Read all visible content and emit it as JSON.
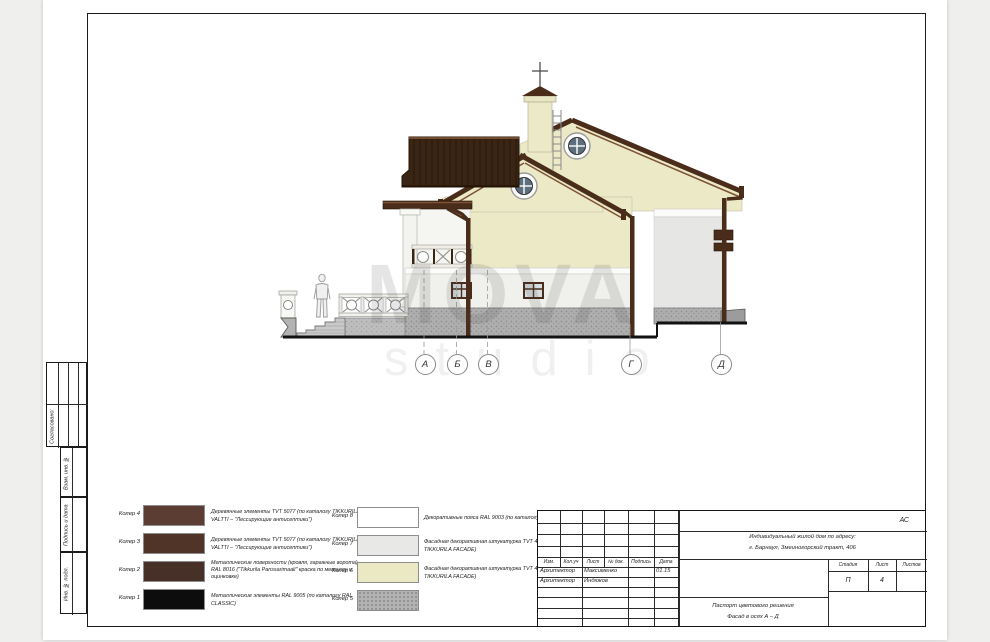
{
  "sheet": {
    "code": "АС",
    "project_line1": "Индивидуальный жилой дом по адресу:",
    "project_line2": "г. Барнаул, Змеиногорский тракт, 406",
    "doc_line1": "Паспорт цветового решения",
    "doc_line2": "Фасад в осях А – Д",
    "columns": [
      "Изм.",
      "Кол.уч",
      "Лист",
      "№ док.",
      "Подпись",
      "Дата"
    ],
    "rows": [
      {
        "role": "Архитектор",
        "surname": "Максименко",
        "signature": "",
        "date": "01.15"
      },
      {
        "role": "Архитектор",
        "surname": "Индюков",
        "signature": "",
        "date": ""
      }
    ],
    "stage_table": {
      "headers": [
        "Стадия",
        "Лист",
        "Листов"
      ],
      "stage": "П",
      "sheet_no": "4",
      "total": ""
    }
  },
  "margin": [
    "Согласовано:",
    "Взам. инв. №",
    "Подпись и дата",
    "Инв. № подл."
  ],
  "axes": {
    "labels": [
      "А",
      "Б",
      "В",
      "Г",
      "Д"
    ]
  },
  "watermark": {
    "line1": "MOVA",
    "line2": "studio"
  },
  "legend": {
    "left": [
      {
        "label": "Колер 4",
        "color": "#5b3d33",
        "desc": "Деревянные элементы TVT 5077 (по каталогу TIKKURILA VALTTI –  \"Лессирующие антисептики\")"
      },
      {
        "label": "Колер 3",
        "color": "#503428",
        "desc": "Деревянные элементы TVT 5077 (по каталогу TIKKURILA VALTTI –  \"Лессирующие антисептики\")"
      },
      {
        "label": "Колер 2",
        "color": "#473028",
        "desc": "Металлические поверхности (кровля, гаражные ворота) RAL 8016 (\"Tikkurila Panssarimaali\" краска по металлу и оцинковке)"
      },
      {
        "label": "Колер 1",
        "color": "#0d0d0d",
        "desc": "Металлические элементы RAL 9005 (по каталогу RAL CLASSIC)"
      }
    ],
    "right": [
      {
        "label": "Колер 8",
        "color": "#ffffff",
        "desc": "Декоративные пояса RAL 9003 (по каталогу RAL CLASSIC)"
      },
      {
        "label": "Колер 7",
        "color": "#e8e8e6",
        "desc": "Фасадная декоративная штукатурка TVT 4902 (по каталогу TIKKURILA FACADE)"
      },
      {
        "label": "Колер 6",
        "color": "#ebe9c4",
        "desc": "Фасадная декоративная штукатурка TVT 4932 (по каталогу TIKKURILA FACADE)"
      },
      {
        "label": "Колер 5",
        "color": "#b2b2b2",
        "desc": ""
      }
    ]
  },
  "palette": {
    "wall_cream": "#ece9c6",
    "wall_light": "#f0f0ec",
    "wall_gray": "#e6e6e4",
    "plinth": "#aeaeae",
    "roof_brown": "#3a2414",
    "trim_brown": "#4a2c1b"
  }
}
